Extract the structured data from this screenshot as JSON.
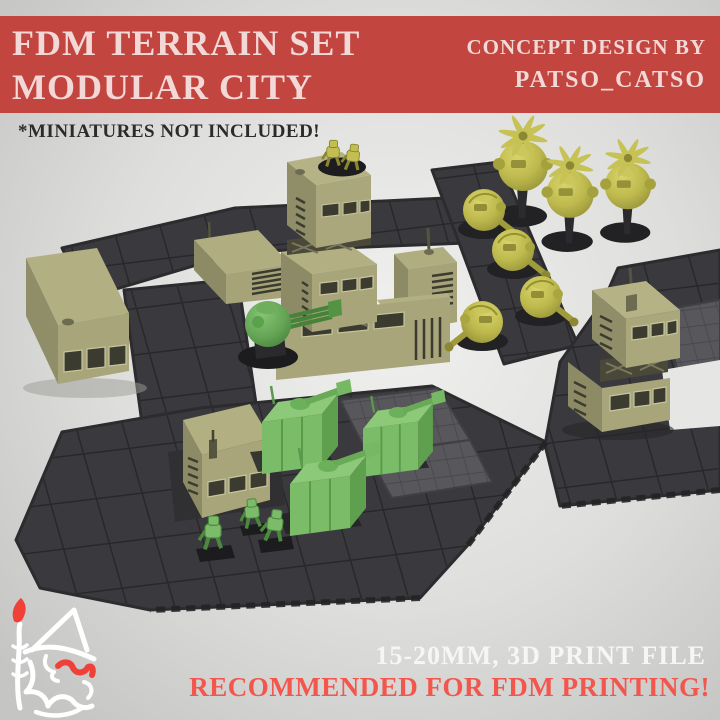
{
  "poster": {
    "background_color": "#c7c7c6",
    "banner": {
      "bg_color": "#c2453f",
      "text_color": "#f2d8d6",
      "title_line1": "FDM TERRAIN SET",
      "title_line2": "MODULAR CITY",
      "credit_line1": "CONCEPT DESIGN BY",
      "credit_line2": "PATSO_CATSO"
    },
    "disclaimer": {
      "text": "*MINIATURES NOT INCLUDED!",
      "color": "#2b2b2b"
    },
    "footer": {
      "spec_line": "15-20MM, 3D PRINT FILE",
      "spec_color": "#f6f6f5",
      "recommendation_line": "RECOMMENDED FOR FDM PRINTING!",
      "recommendation_color": "#f2564c"
    },
    "logo": {
      "name": "witch-mascot-logo",
      "stroke_color": "#ffffff",
      "accent_color": "#ef4137"
    },
    "scene": {
      "name": "modular-city-3d-render",
      "objects": [
        "dark modular floor plates",
        "light fine-grid floor plates",
        "khaki modular buildings",
        "stacked tower building",
        "green box turrets",
        "green gatling ball turret",
        "green infantry mechs",
        "yellow ball turret drones",
        "yellow rotor drones on stands",
        "yellow infantry mechs on tower roof"
      ],
      "palette": {
        "plate_dark": "#3a3a3e",
        "plate_light": "#57575c",
        "building_khaki": "#a9a77b",
        "mech_green": "#7abc67",
        "drone_yellow": "#bdb94d",
        "base_black": "#1d1d1f"
      }
    }
  }
}
